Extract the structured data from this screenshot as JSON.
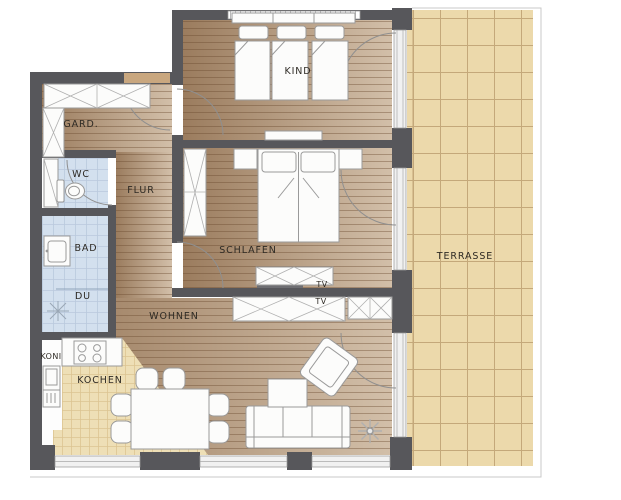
{
  "plan": {
    "title": "apartment-floor-plan",
    "rooms": {
      "gard": "GARD.",
      "wc": "WC",
      "flur": "FLUR",
      "bad": "BAD",
      "du": "DU",
      "koni": "KONI",
      "kochen": "KOCHEN",
      "wohnen": "WOHNEN",
      "schlafen": "SCHLAFEN",
      "kind": "KIND",
      "terrasse": "TERRASSE",
      "tv_top": "TV",
      "tv_bottom": "TV"
    },
    "colors": {
      "wall": "#57575b",
      "wood_dark": "#9b7c5e",
      "wood_light": "#d2bfa9",
      "terrace": "#ecd9ab",
      "terrace_grid": "#c4a87a",
      "kitchen": "#eedfb6",
      "kitchen_grid": "#dcc592",
      "bath": "#d3e0ee",
      "bath_grid": "#bac9dd",
      "door": "#c9a77f",
      "furniture_stroke": "#9a9a9a",
      "label_text": "#2e2a24"
    }
  }
}
